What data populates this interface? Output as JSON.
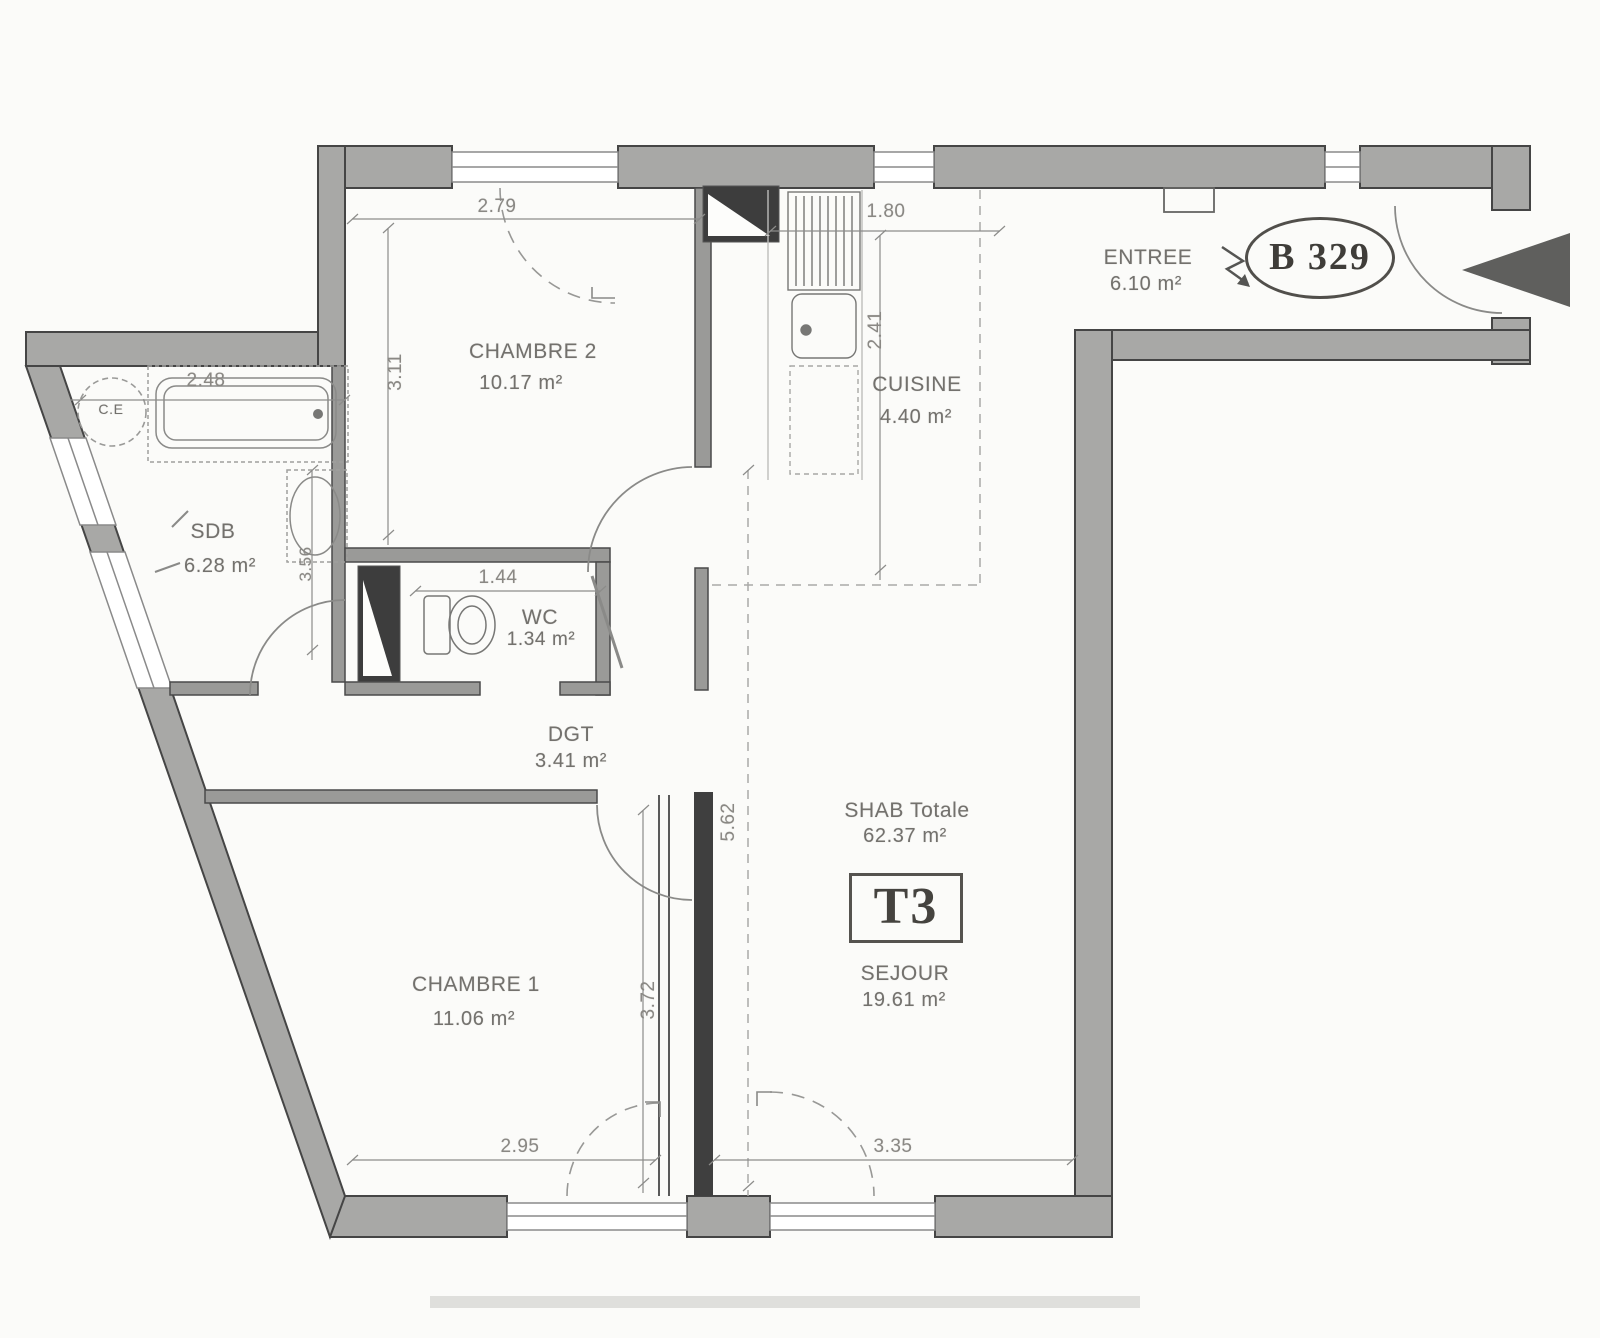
{
  "plan": {
    "unit": "B 329",
    "type": "T3",
    "shab": {
      "label": "SHAB Totale",
      "area": "62.37 m²"
    },
    "rooms": [
      {
        "name": "ENTREE",
        "area": "6.10 m²"
      },
      {
        "name": "CHAMBRE 2",
        "area": "10.17 m²"
      },
      {
        "name": "CUISINE",
        "area": "4.40 m²"
      },
      {
        "name": "SDB",
        "area": "6.28 m²"
      },
      {
        "name": "WC",
        "area": "1.34 m²"
      },
      {
        "name": "DGT",
        "area": "3.41 m²"
      },
      {
        "name": "SEJOUR",
        "area": "19.61 m²"
      },
      {
        "name": "CHAMBRE 1",
        "area": "11.06 m²"
      }
    ],
    "dims": {
      "chambre2_width": "2.79",
      "chambre2_height": "3.11",
      "cuisine_width": "1.80",
      "cuisine_height": "2.41",
      "sdb_width": "2.48",
      "sdb_height": "3.56",
      "wc_width": "1.44",
      "sejour_height": "5.62",
      "chambre1_height": "3.72",
      "chambre1_width": "2.95",
      "sejour_width": "3.35"
    },
    "fixtures": {
      "water_heater": "C.E"
    }
  }
}
